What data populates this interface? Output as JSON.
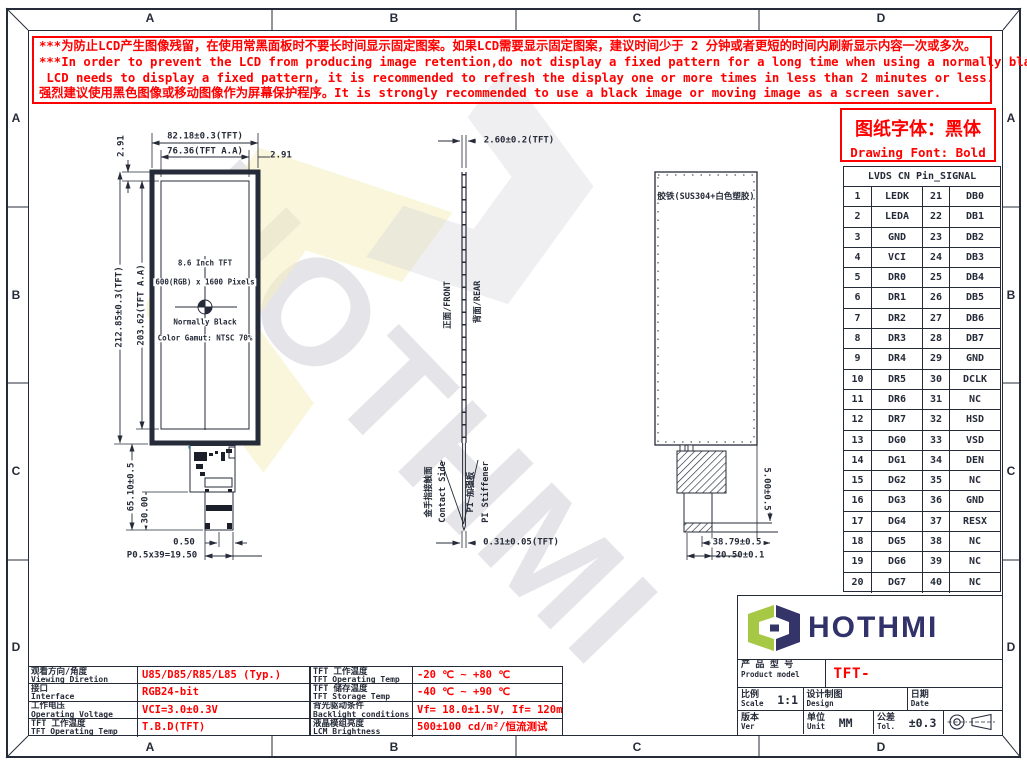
{
  "colors": {
    "line": "#252b38",
    "red": "#ff0000",
    "logo_green": "#a6c844",
    "logo_navy": "#343469",
    "fpc_blue": "#62bcd8",
    "wm_yellow": "#f5efbe"
  },
  "zones": {
    "cols": [
      "A",
      "B",
      "C",
      "D"
    ],
    "rows": [
      "A",
      "B",
      "C",
      "D"
    ]
  },
  "warning": {
    "lines": [
      "***为防止LCD产生图像残留，在使用常黑面板时不要长时间显示固定图案。如果LCD需要显示固定图案，建议时间少于 2 分钟或者更短的时间内刷新显示内容一次或多次。",
      "***In order to prevent the LCD from producing image retention,do not display a fixed pattern for a long time when using a normally black panel.If the",
      " LCD needs to display a fixed pattern, it is recommended to refresh the display one or more times in less than 2 minutes or less.",
      "强烈建议使用黑色图像或移动图像作为屏幕保护程序。It is strongly recommended to use a black image or moving image as a screen saver."
    ]
  },
  "font_note": {
    "cn": "图纸字体：黑体",
    "en": "Drawing Font: Bold"
  },
  "watermark": {
    "text": "HOTHMI"
  },
  "front_view": {
    "screen_lines": [
      "8.6 Inch TFT",
      "600(RGB) x 1600 Pixels",
      "Normally Black",
      "Color Gamut: NTSC 70%"
    ],
    "dims": {
      "total_width": "82.18±0.3(TFT)",
      "aa_width": "76.36(TFT A.A)",
      "right_margin": "2.91",
      "top_margin": "2.91",
      "total_height": "212.85±0.3(TFT)",
      "aa_height": "203.62(TFT A.A)",
      "fpc_length": "65.10±0.5",
      "fpc_tail": "30.00",
      "pin_pitch": "0.50",
      "pitch_total": "P0.5x39=19.50"
    }
  },
  "side_view": {
    "thickness": "2.60±0.2(TFT)",
    "front_label": "正面/FRONT",
    "rear_label": "背面/REAR",
    "contact_cn": "金手指接触面",
    "contact_en": "Contact Side",
    "stiffener_cn": "PI 加强板",
    "stiffener_en": "PI Stiffener",
    "fpc_thickness": "0.31±0.05(TFT)"
  },
  "rear_view": {
    "cover_label": "胶铁(SUS304+白色塑胶)",
    "fpc_offset": "5.00±0.5",
    "fpc_width": "38.79±0.5",
    "connector_width": "20.50±0.1"
  },
  "pin_table": {
    "title": "LVDS CN Pin_SIGNAL",
    "rows": [
      [
        "1",
        "LEDK",
        "21",
        "DB0"
      ],
      [
        "2",
        "LEDA",
        "22",
        "DB1"
      ],
      [
        "3",
        "GND",
        "23",
        "DB2"
      ],
      [
        "4",
        "VCI",
        "24",
        "DB3"
      ],
      [
        "5",
        "DR0",
        "25",
        "DB4"
      ],
      [
        "6",
        "DR1",
        "26",
        "DB5"
      ],
      [
        "7",
        "DR2",
        "27",
        "DB6"
      ],
      [
        "8",
        "DR3",
        "28",
        "DB7"
      ],
      [
        "9",
        "DR4",
        "29",
        "GND"
      ],
      [
        "10",
        "DR5",
        "30",
        "DCLK"
      ],
      [
        "11",
        "DR6",
        "31",
        "NC"
      ],
      [
        "12",
        "DR7",
        "32",
        "HSD"
      ],
      [
        "13",
        "DG0",
        "33",
        "VSD"
      ],
      [
        "14",
        "DG1",
        "34",
        "DEN"
      ],
      [
        "15",
        "DG2",
        "35",
        "NC"
      ],
      [
        "16",
        "DG3",
        "36",
        "GND"
      ],
      [
        "17",
        "DG4",
        "37",
        "RESX"
      ],
      [
        "18",
        "DG5",
        "38",
        "NC"
      ],
      [
        "19",
        "DG6",
        "39",
        "NC"
      ],
      [
        "20",
        "DG7",
        "40",
        "NC"
      ]
    ]
  },
  "spec_left": {
    "rows": [
      {
        "cn": "观看方向/角度",
        "en": "Viewing Diretion",
        "value": "U85/D85/R85/L85 (Typ.)"
      },
      {
        "cn": "接口",
        "en": "Interface",
        "value": "RGB24-bit"
      },
      {
        "cn": "工作电压",
        "en": "Operating Voltage",
        "value": "VCI=3.0±0.3V"
      },
      {
        "cn": "TFT 工作温度",
        "en": "TFT Operating Temp",
        "value": "T.B.D(TFT)"
      }
    ]
  },
  "spec_mid": {
    "rows": [
      {
        "cn": "TFT 工作温度",
        "en": "TFT Operating Temp",
        "value": "-20 ℃ ~ +80 ℃"
      },
      {
        "cn": "TFT 储存温度",
        "en": "TFT Storage Temp",
        "value": "-40 ℃ ~ +90 ℃"
      },
      {
        "cn": "背光驱动条件",
        "en": "Backlight conditions",
        "value": "Vf= 18.0±1.5V, If= 120mA"
      },
      {
        "cn": "液晶模组亮度",
        "en": "LCM Brightness",
        "value": "500±100 cd/m²/恒流测试"
      }
    ]
  },
  "title_block": {
    "brand": "HOTHMI",
    "product_label_cn": "产 品 型 号",
    "product_label_en": "Product model",
    "model": "TFT-H086A01ZRIGC5N40",
    "scale_cn": "比例",
    "scale_en": "Scale",
    "scale_value": "1:1",
    "design_cn": "设计制图",
    "design_en": "Design",
    "design_value": "Liu. YL",
    "date_cn": "日期",
    "date_en": "Date",
    "date_value": "2025-08-21",
    "ver_cn": "版本",
    "ver_en": "Ver",
    "ver_value": "V0-0",
    "unit_cn": "单位",
    "unit_en": "Unit",
    "unit_value": "MM",
    "tol_cn": "公差",
    "tol_en": "Tol.",
    "tol_value": "±0.3"
  }
}
